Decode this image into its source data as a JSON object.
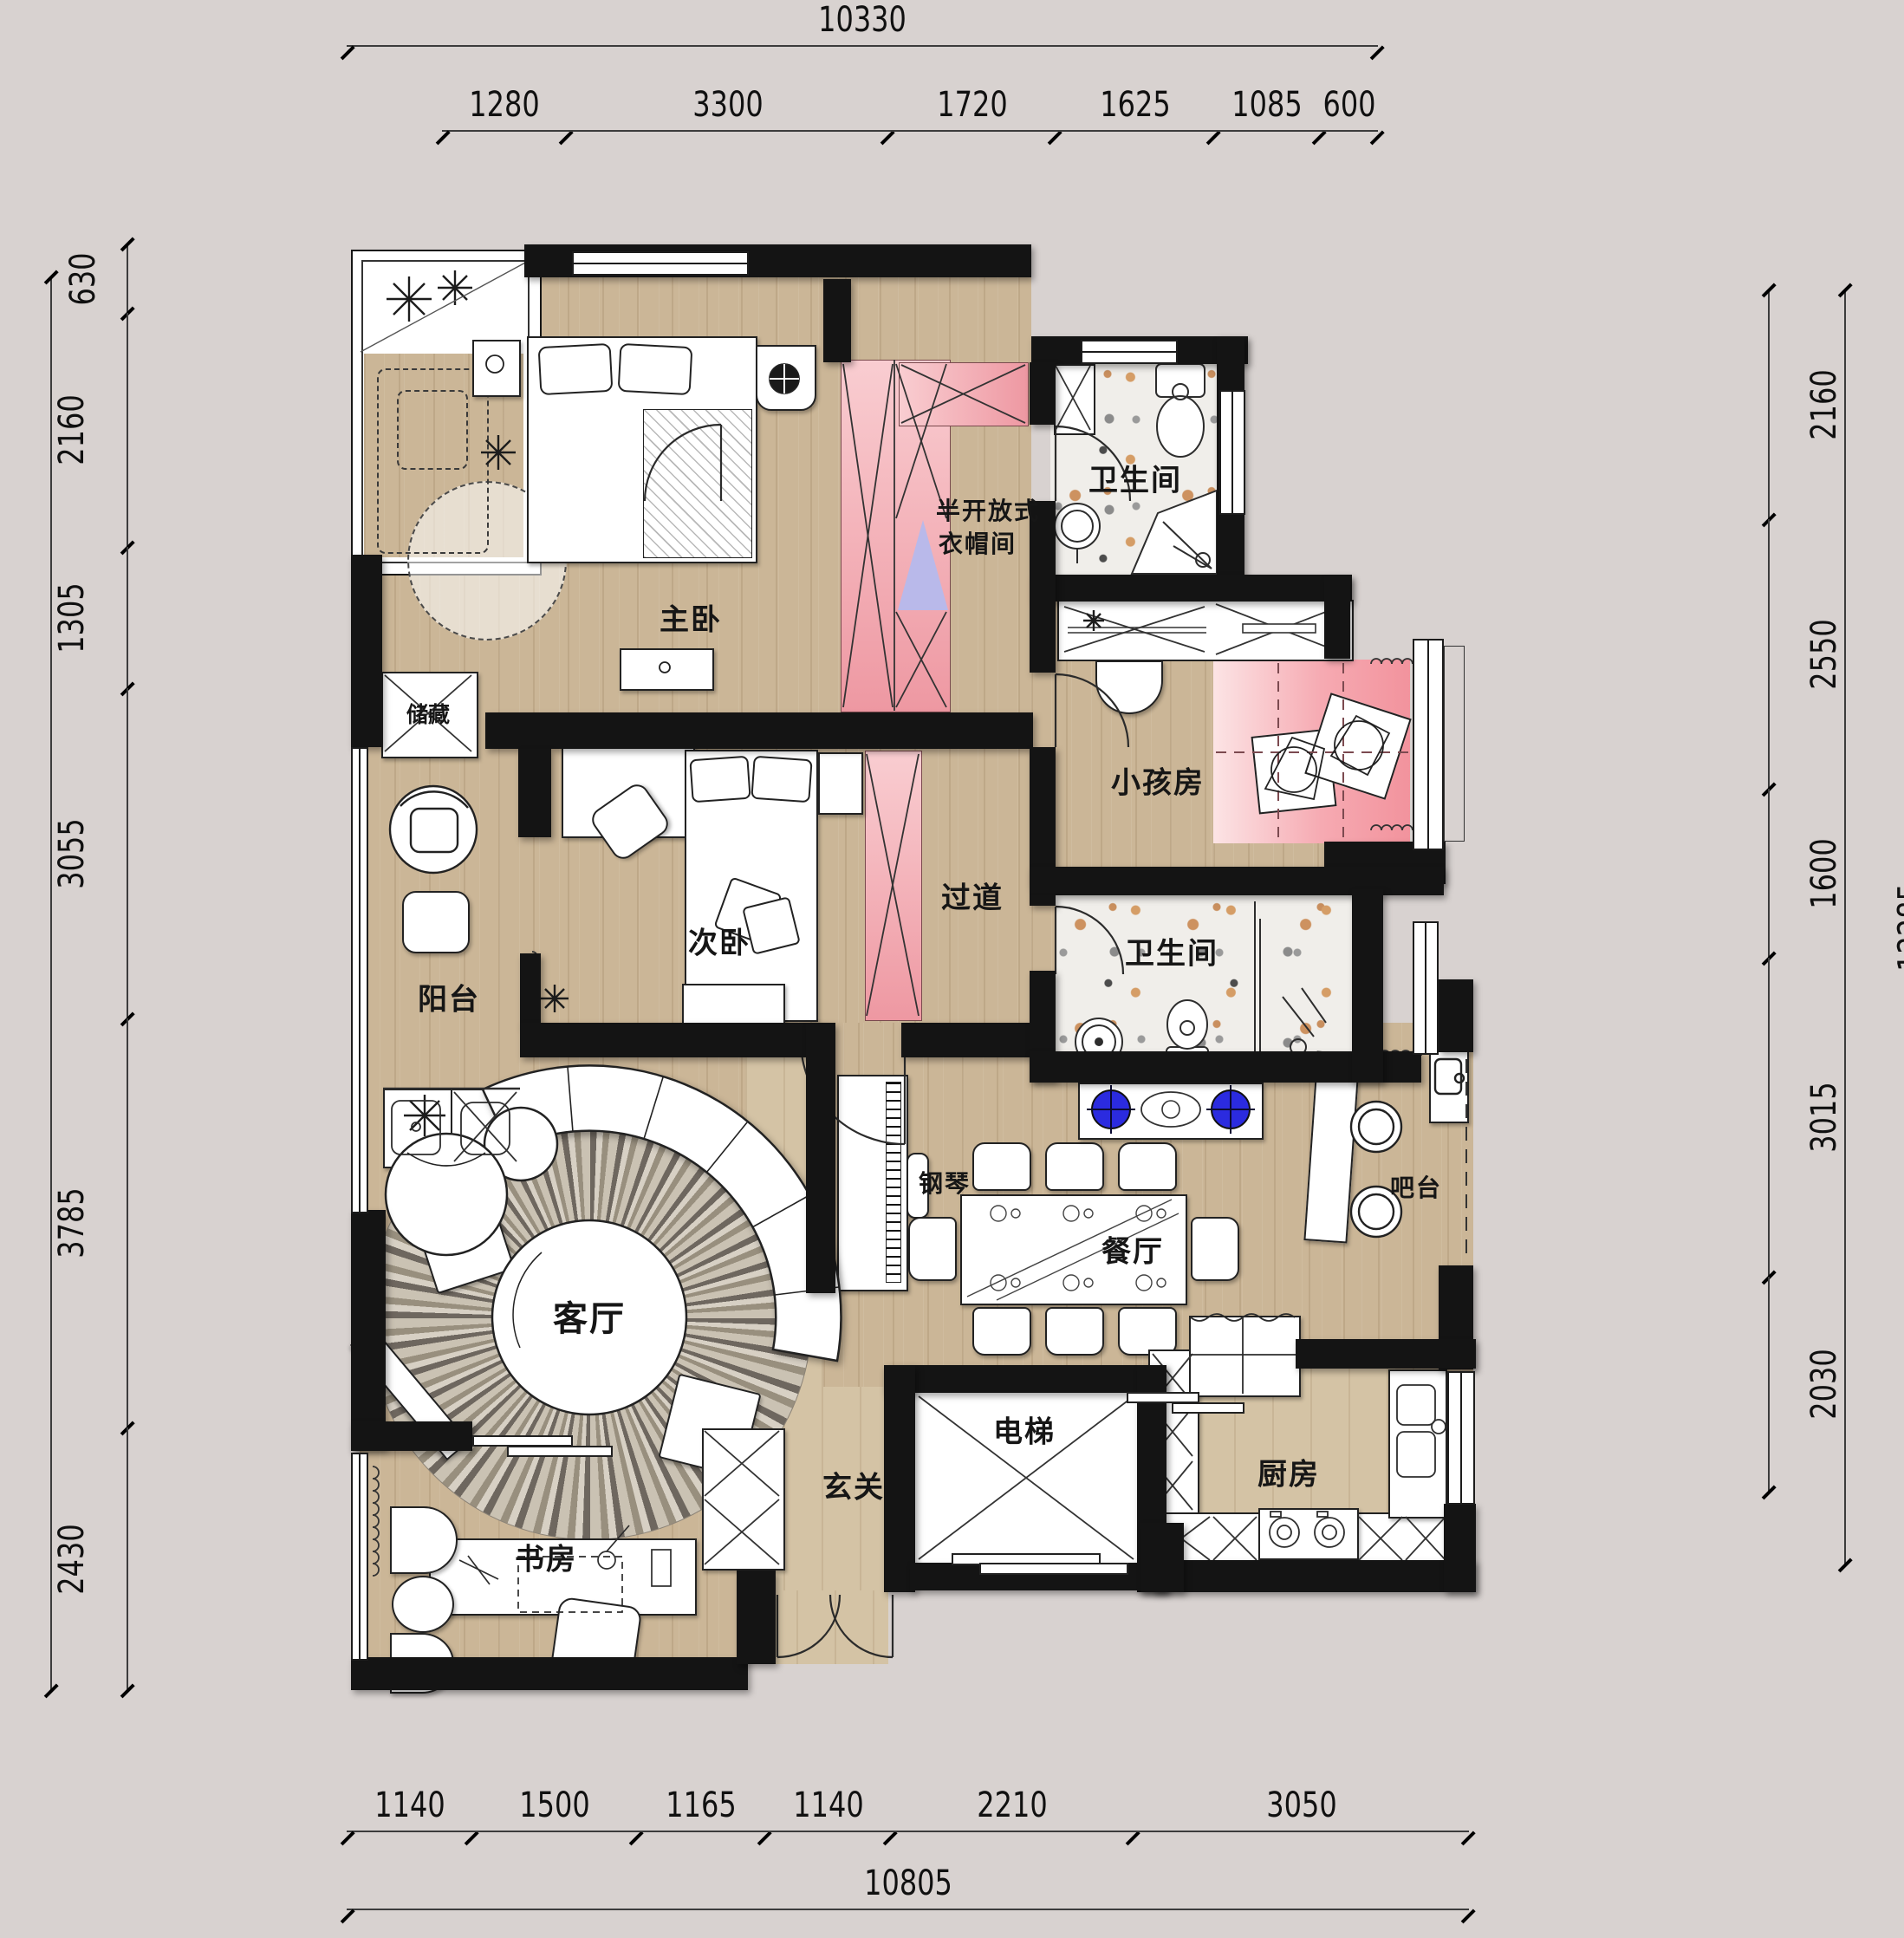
{
  "plan": {
    "type": "apartment-floor-plan",
    "rooms": {
      "master_bedroom": "主卧",
      "cloakroom_line1": "半开放式",
      "cloakroom_line2": "衣帽间",
      "bathroom_top": "卫生间",
      "kids_room": "小孩房",
      "corridor": "过道",
      "second_bedroom": "次卧",
      "balcony": "阳台",
      "storage": "储藏",
      "bathroom_mid": "卫生间",
      "living_room": "客厅",
      "piano": "钢琴",
      "dining_room": "餐厅",
      "bar": "吧台",
      "foyer": "玄关",
      "elevator": "电梯",
      "kitchen": "厨房",
      "study": "书房"
    },
    "dimensions": {
      "top": {
        "total": "10330",
        "segments": [
          "1280",
          "3300",
          "1720",
          "1625",
          "1085",
          "600"
        ]
      },
      "bottom": {
        "total": "10805",
        "segments": [
          "1140",
          "1500",
          "1165",
          "1140",
          "2210",
          "3050"
        ]
      },
      "left": {
        "total": "13490",
        "segments": [
          "630",
          "2160",
          "1305",
          "3055",
          "3785",
          "2430"
        ]
      },
      "right": {
        "total": "12285",
        "segments": [
          "2160",
          "2550",
          "1600",
          "3015",
          "2030"
        ]
      }
    },
    "colors": {
      "wall": "#141414",
      "wood_floor": "#cbb697",
      "terrazzo_floor": "#f0eeea",
      "kids_pink": "#f6aab2",
      "wardrobe_pink": "#ee98a2",
      "burner_blue": "#2b2bdf",
      "background": "#d8d2d0"
    }
  }
}
